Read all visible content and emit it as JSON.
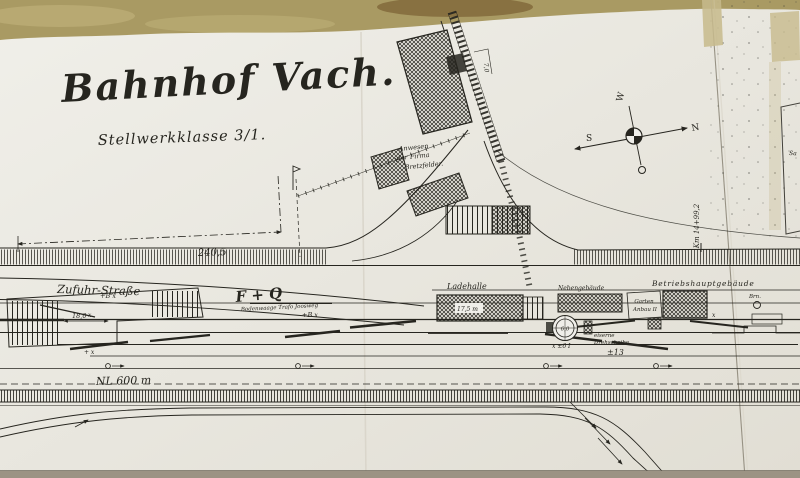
{
  "plan": {
    "title": "Bahnhof Vach.",
    "subtitle": "Stellwerkklasse 3/1.",
    "compass": {
      "n": "N",
      "s": "S",
      "w": "W",
      "o": "O"
    },
    "streets": {
      "zufuhr": "Zufuhr-Straße"
    },
    "buildings": {
      "ladehalle": "Ladehalle",
      "nebengebaeude": "Nebengebäude",
      "betriebshauptgebaeude": "Betriebshauptgebäude",
      "garten": "Garten",
      "anbau": "Anbau II"
    },
    "annotations": {
      "km_marker": "Km 14+99,2",
      "dim_main": "240,5",
      "dim_shed": "18,0",
      "dim_hall": "17,5 m",
      "dim_path": "7,0",
      "turntable_diameter": "6,0",
      "turntable_label_1": "eiserne",
      "turntable_label_2": "Drehscheibe",
      "useful_length": "NL 600 m",
      "gradient_mark": "±13",
      "switch_mark": "+B x",
      "point_mark": "x ±6 I",
      "initials": "F + Q",
      "scale_note": "Bodenwaage Trafo Joosweg",
      "property_1": "Anwesen",
      "property_2": "der Firma",
      "property_3": "Bretzfelder.",
      "well": "Brn.",
      "sheet_corner": "Sa"
    },
    "marks": {
      "x": "x",
      "plus_x": "+ x"
    }
  },
  "colors": {
    "table": "#a99a63",
    "paper_light": "#efeee9",
    "paper_dark": "#e2dfd5",
    "ink": "#26251f",
    "tape": "#c7ba8c",
    "seam": "#8e887a",
    "table_edge": "#9c9384"
  }
}
